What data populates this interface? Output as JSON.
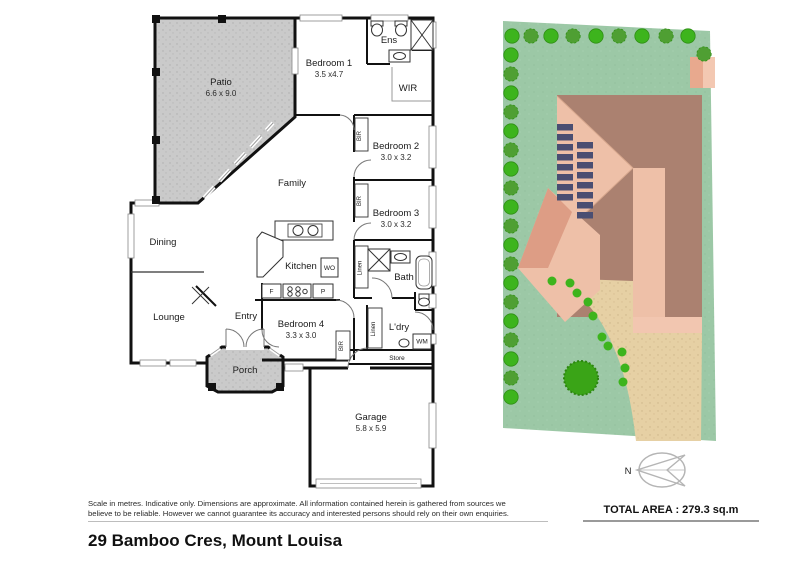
{
  "floorplan": {
    "rooms": [
      {
        "name": "Patio",
        "dims": "6.6 x 9.0"
      },
      {
        "name": "Bedroom 1",
        "dims": "3.5 x4.7"
      },
      {
        "name": "Ens"
      },
      {
        "name": "WIR"
      },
      {
        "name": "Bedroom 2",
        "dims": "3.0 x 3.2"
      },
      {
        "name": "Bedroom 3",
        "dims": "3.0 x 3.2"
      },
      {
        "name": "Family"
      },
      {
        "name": "Dining"
      },
      {
        "name": "Kitchen"
      },
      {
        "name": "Lounge"
      },
      {
        "name": "Entry"
      },
      {
        "name": "Bedroom 4",
        "dims": "3.3 x 3.0"
      },
      {
        "name": "Porch"
      },
      {
        "name": "Bath"
      },
      {
        "name": "L'dry"
      },
      {
        "name": "Store"
      },
      {
        "name": "Garage",
        "dims": "5.8 x 5.9"
      }
    ],
    "fixtures": {
      "bir": "BIR",
      "linen": "Linen",
      "wall_oven": "WO",
      "fridge": "F",
      "pantry": "P",
      "washing_machine": "WM"
    }
  },
  "siteplan": {
    "compass_north": "N",
    "total_area": "TOTAL AREA : 279.3 sq.m"
  },
  "footer": {
    "disclaimer_line1": "Scale in metres. Indicative only. Dimensions are approximate. All information contained herein is gathered from sources we",
    "disclaimer_line2": "believe to be reliable. However we cannot guarantee its accuracy and interested persons should rely on their own enquiries.",
    "address_title": "29 Bamboo Cres, Mount Louisa"
  },
  "colors": {
    "lawn": "#9cc8a6",
    "tree_bright": "#3db41d",
    "tree_dark": "#4f9f33",
    "roof_dark": "#ab8170",
    "roof_light": "#eec0a8",
    "roof_mid": "#dd9d85",
    "solar_panel": "#4a4e72",
    "driveway": "#e6d0a4",
    "paving": "#c9c9c9"
  }
}
